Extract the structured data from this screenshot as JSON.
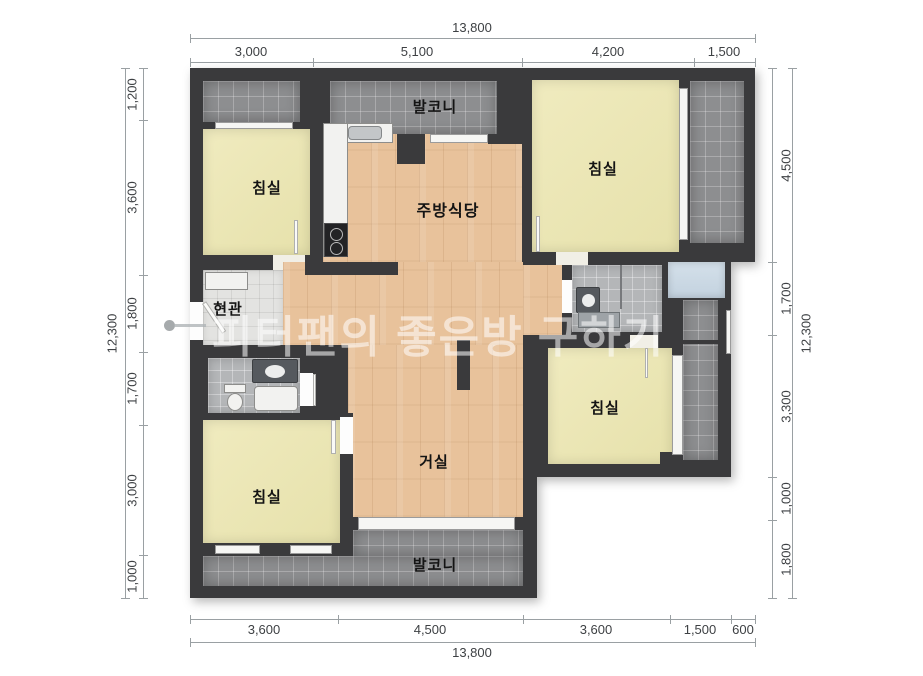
{
  "title": "apartment-floor-plan",
  "watermark": {
    "text": "피터팬의 좋은방 구하기"
  },
  "rooms": {
    "balcony_top": "발코니",
    "bedroom_top_left": "침실",
    "kitchen_dining": "주방식당",
    "bedroom_top_right": "침실",
    "entrance": "현관",
    "bedroom_mid_right": "침실",
    "living_room": "거실",
    "bedroom_bottom_left": "침실",
    "balcony_bottom": "발코니"
  },
  "dimensions": {
    "top": {
      "total": "13,800",
      "segments": [
        "3,000",
        "5,100",
        "4,200",
        "1,500"
      ]
    },
    "bottom": {
      "total": "13,800",
      "segments": [
        "3,600",
        "4,500",
        "3,600",
        "1,500",
        "600"
      ]
    },
    "left": {
      "total": "12,300",
      "segments": [
        "1,200",
        "3,600",
        "1,800",
        "1,700",
        "3,000",
        "1,000"
      ]
    },
    "right": {
      "total": "12,300",
      "segments": [
        "4,500",
        "1,700",
        "3,300",
        "1,000",
        "1,800"
      ]
    }
  },
  "colors": {
    "wall": "#3a3a3c",
    "wood_floor": "#e8c29b",
    "bedroom_floor": "#ebe6b5",
    "balcony_tile": "#8d8e90",
    "bath_tile": "#b4b6b8",
    "entrance_tile": "#e3e3e1",
    "utility_room": "#ccdae6"
  }
}
